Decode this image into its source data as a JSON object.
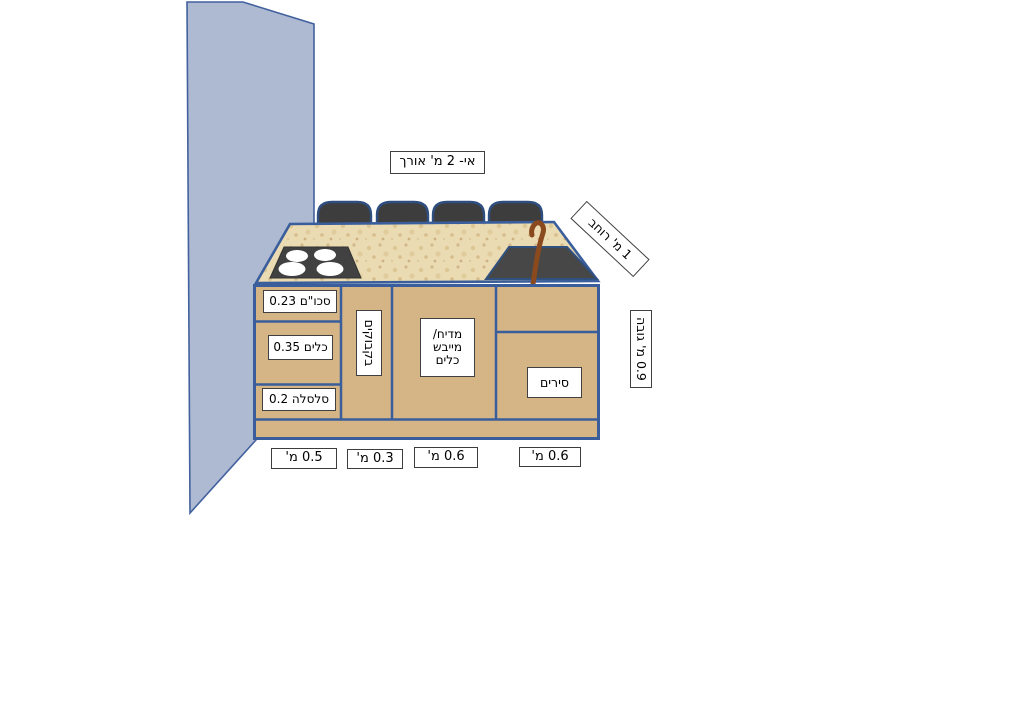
{
  "labels": {
    "island_length": "אי- 2 מ' אורך",
    "island_width": "1 מ' רוחב",
    "island_height": "0.9 מ' גובה"
  },
  "cabinets": {
    "cutlery": "סכו\"ם 0.23",
    "dishes": "כלים 0.35",
    "basket": "סלסלה 0.2",
    "bottles": "בקבוקים",
    "dishwasher_line1": "מדיח/",
    "dishwasher_line2": "מייבש",
    "dishwasher_line3": "כלים",
    "pots": "סירים"
  },
  "bottom_measurements": [
    "0.5 מ'",
    "0.3 מ'",
    "0.6 מ'",
    "0.6 מ'"
  ],
  "colors": {
    "wall_fill": "#aeb9d2",
    "wall_border": "#42619e",
    "cabinet_fill": "#d5b486",
    "counter_fill": "#ebdbb3",
    "counter_speckle": "#d2b98a",
    "outline_blue": "#3a5e9c",
    "appliance_dark": "#414141",
    "pot_fill": "#3d3d3d",
    "pot_outline": "#2f4e80",
    "burner_white": "#ffffff",
    "faucet_brown": "#8a4a1e"
  }
}
